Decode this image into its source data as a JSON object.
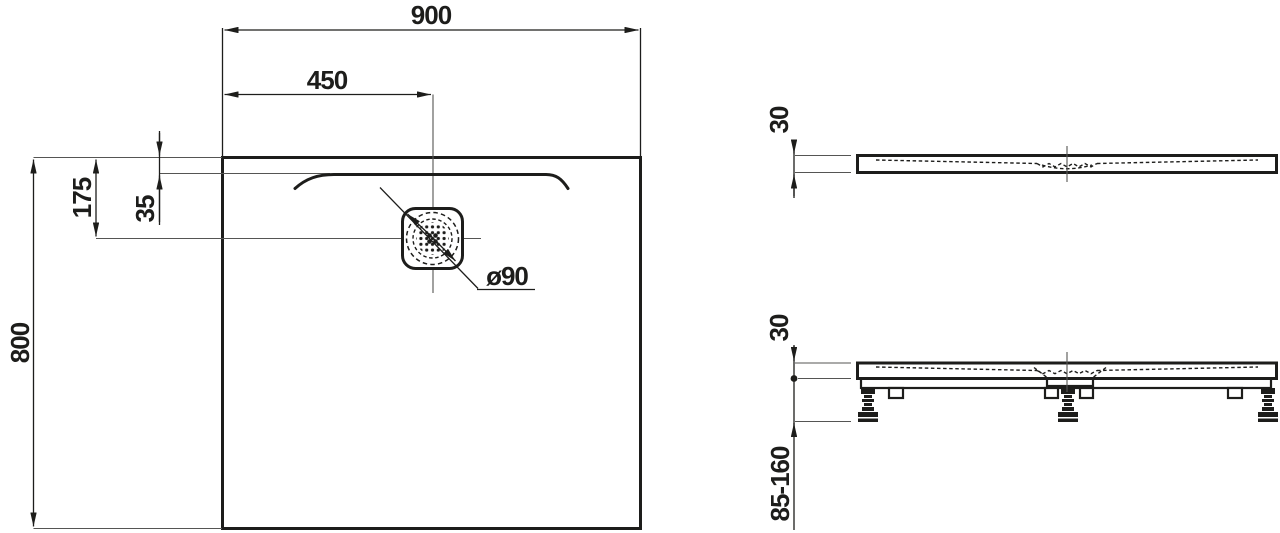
{
  "colors": {
    "line": "#1d1d1b",
    "thin_line": "#555553",
    "background": "#ffffff"
  },
  "plan_view": {
    "overall_width_label": "900",
    "drain_offset_from_left_label": "450",
    "overall_depth_label": "800",
    "drain_offset_from_top_label": "175",
    "slope_edge_offset_label": "35",
    "drain_diameter_label": "ø90"
  },
  "side_view_top": {
    "tray_thickness_label": "30"
  },
  "side_view_bottom": {
    "tray_thickness_label": "30",
    "installation_height_range_label": "85-160"
  }
}
